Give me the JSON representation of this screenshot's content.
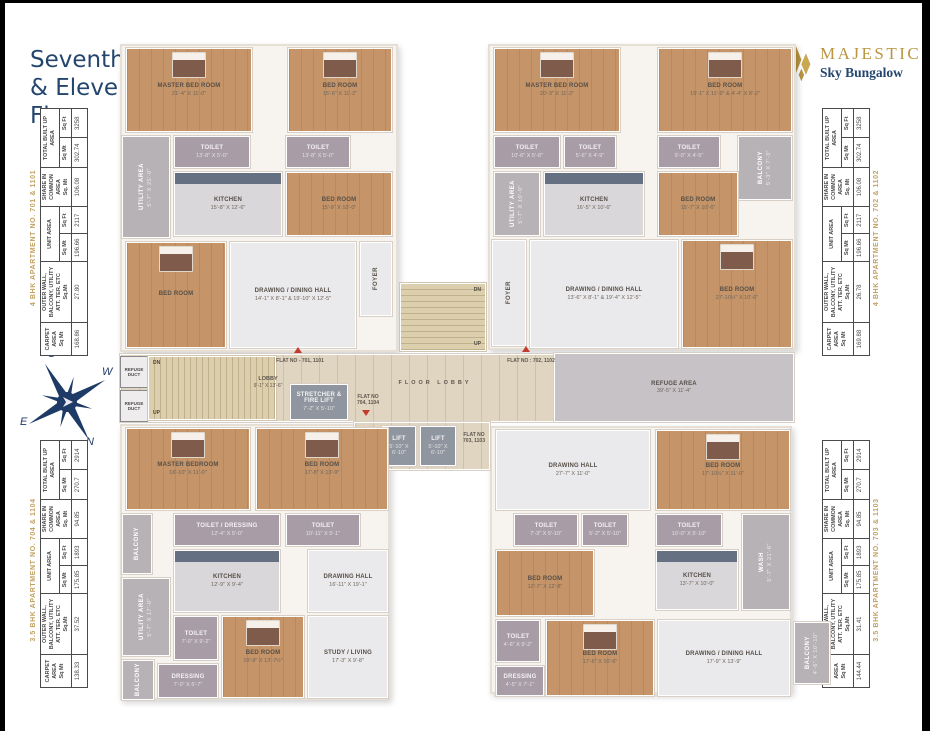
{
  "page": {
    "title": "Seventh\n& Eleventh\nFloor"
  },
  "logo": {
    "name": "MAJESTIC",
    "subtitle": "Sky Bungalow",
    "gold": "#b9953f",
    "navy": "#24466e"
  },
  "compass": {
    "n": "N",
    "s": "S",
    "e": "E",
    "w": "W"
  },
  "area_tables": {
    "headers": {
      "carpet": "CARPET\nAREA\nSq Mt",
      "outer": "OUTER WALL,\nBALCONY, UTILITY\nATT. TER. ETC\nSq.Mt",
      "unit": "UNIT AREA",
      "share": "SHARE IN\nCOMMON\nAREA\nSq. Mt",
      "total": "TOTAL BUILT UP\nAREA",
      "sqmt": "Sq Mt",
      "sqft": "Sq Ft"
    },
    "tables": [
      {
        "label": "4 BHK APARTMENT NO. 701 & 1101",
        "carpet": "168.86",
        "outer": "27.80",
        "unit_sqmt": "196.66",
        "unit_sqft": "2117",
        "share": "106.08",
        "total_sqmt": "302.74",
        "total_sqft": "3258"
      },
      {
        "label": "4 BHK APARTMENT NO. 702 & 1102",
        "carpet": "169.88",
        "outer": "26.78",
        "unit_sqmt": "196.66",
        "unit_sqft": "2117",
        "share": "106.08",
        "total_sqmt": "302.74",
        "total_sqft": "3258"
      },
      {
        "label": "3.5 BHK APARTMENT NO. 704 & 1104",
        "carpet": "138.33",
        "outer": "37.52",
        "unit_sqmt": "175.85",
        "unit_sqft": "1893",
        "share": "94.85",
        "total_sqmt": "270.7",
        "total_sqft": "2914"
      },
      {
        "label": "3.5 BHK APARTMENT NO. 703 & 1103",
        "carpet": "144.44",
        "outer": "31.41",
        "unit_sqmt": "175.85",
        "unit_sqft": "1893",
        "share": "94.85",
        "total_sqmt": "270.7",
        "total_sqft": "2914"
      }
    ]
  },
  "plan": {
    "a701": {
      "rooms": [
        {
          "n": "MASTER BED ROOM",
          "d": "21'-4\" X 11'-0\""
        },
        {
          "n": "BED ROOM",
          "d": "15'-6\" X 11'-2\""
        },
        {
          "n": "TOILET",
          "d": "13'-8\" X 5'-0\""
        },
        {
          "n": "TOILET",
          "d": "13'-8\" X 5'-0\""
        },
        {
          "n": "UTILITY AREA",
          "d": "5'-7\" X 25'-0\""
        },
        {
          "n": "KITCHEN",
          "d": "15'-8\" X 12'-6\""
        },
        {
          "n": "BED ROOM",
          "d": "15'-9\" X 10'-0\""
        },
        {
          "n": "BED ROOM",
          "d": ""
        },
        {
          "n": "DRAWING / DINING HALL",
          "d": "14'-1\" X 8'-1\" & 19'-10\" X 12'-5\""
        },
        {
          "n": "FOYER",
          "d": ""
        }
      ]
    },
    "a702": {
      "rooms": [
        {
          "n": "MASTER BED ROOM",
          "d": "20'-3\" X 11'-2\""
        },
        {
          "n": "BED ROOM",
          "d": "15'-1\" X 11'-9\" & 4'-4\" X 8'-2\""
        },
        {
          "n": "TOILET",
          "d": "10'-6\" X 5'-8\""
        },
        {
          "n": "TOILET",
          "d": "5'-6\" X 4'-9\""
        },
        {
          "n": "TOILET",
          "d": "9'-0\" X 4'-5\""
        },
        {
          "n": "BALCONY",
          "d": "5'-3\" X 7'-3\""
        },
        {
          "n": "UTILITY AREA",
          "d": "5'-7\" X 10'-9\""
        },
        {
          "n": "KITCHEN",
          "d": "16'-5\" X 10'-6\""
        },
        {
          "n": "BED ROOM",
          "d": "15'-7\" X 10'-6\""
        },
        {
          "n": "FOYER",
          "d": ""
        },
        {
          "n": "DRAWING / DINING HALL",
          "d": "13'-6\" X 8'-1\" & 19'-4\" X 12'-5\""
        },
        {
          "n": "BED ROOM",
          "d": "27'-10½\" X 10'-6\""
        }
      ]
    },
    "a704": {
      "rooms": [
        {
          "n": "MASTER BEDROOM",
          "d": "16'-10\" X 11'-0\""
        },
        {
          "n": "BED ROOM",
          "d": "17'-8\" X 13'-9\""
        },
        {
          "n": "BALCONY",
          "d": ""
        },
        {
          "n": "TOILET / DRESSING",
          "d": "12'-4\" X 5'-0\""
        },
        {
          "n": "TOILET",
          "d": "10'-11\" X 5'-1\""
        },
        {
          "n": "UTILITY AREA",
          "d": "5'-7\" X 17'-0\""
        },
        {
          "n": "KITCHEN",
          "d": "12'-9\" X 9'-4\""
        },
        {
          "n": "DRAWING HALL",
          "d": "16'-11\" X 19'-1\""
        },
        {
          "n": "STUDY / LIVING",
          "d": "17'-3\" X 9'-8\""
        },
        {
          "n": "TOILET",
          "d": "7'-0\" X 9'-2\""
        },
        {
          "n": "DRESSING",
          "d": "7'-0\" X 6'-7\""
        },
        {
          "n": "BALCONY",
          "d": "5'-7\" X 7'-7\""
        },
        {
          "n": "BED ROOM",
          "d": "10'-9\" X 13'-7½\""
        }
      ]
    },
    "a703": {
      "rooms": [
        {
          "n": "DRAWING HALL",
          "d": "27'-7\" X 11'-0\""
        },
        {
          "n": "BED ROOM",
          "d": "17'-10½\" X 11'-0\""
        },
        {
          "n": "TOILET",
          "d": "7'-3\" X 5'-10\""
        },
        {
          "n": "TOILET",
          "d": "5'-2\" X 5'-10\""
        },
        {
          "n": "TOILET",
          "d": "10'-0\" X 5'-10\""
        },
        {
          "n": "WASH",
          "d": "5'-7\" X 21'-6\""
        },
        {
          "n": "BED ROOM",
          "d": "12'-7\" X 12'-8\""
        },
        {
          "n": "KITCHEN",
          "d": "13'-7\" X 10'-0\""
        },
        {
          "n": "TOILET",
          "d": "4'-6\" X 9'-2\""
        },
        {
          "n": "DRESSING",
          "d": "4'-5\" X 7'-1\""
        },
        {
          "n": "BED ROOM",
          "d": "17'-6\" X 10'-6\""
        },
        {
          "n": "DRAWING / DINING HALL",
          "d": "17'-9\" X 13'-9\""
        },
        {
          "n": "BALCONY",
          "d": "4'-6\" X 10'-10\""
        }
      ]
    },
    "core": {
      "lobby_n": "LOBBY",
      "lobby_d": "9'-1\" X 13'-6\"",
      "stretcher_n": "STRETCHER & FIRE LIFT",
      "stretcher_d": "7'-2\" X 5'-10\"",
      "lift_n": "LIFT",
      "lift_d": "5'-10\" X 6'-10\"",
      "floor_lobby": "FLOOR LOBBY",
      "lift_lobby": "LIFT LOBBY",
      "refuge_n": "REFUGE AREA",
      "refuge_d": "39'-5\" X 11'-4\"",
      "refuge_duct": "REFUGE\nDUCT",
      "dn": "DN",
      "up": "UP",
      "flat701": "FLAT NO - 701, 1101",
      "flat702": "FLAT NO : 702, 1102",
      "flat703": "FLAT NO\n703, 1103",
      "flat704": "FLAT NO\n704, 1104"
    }
  }
}
